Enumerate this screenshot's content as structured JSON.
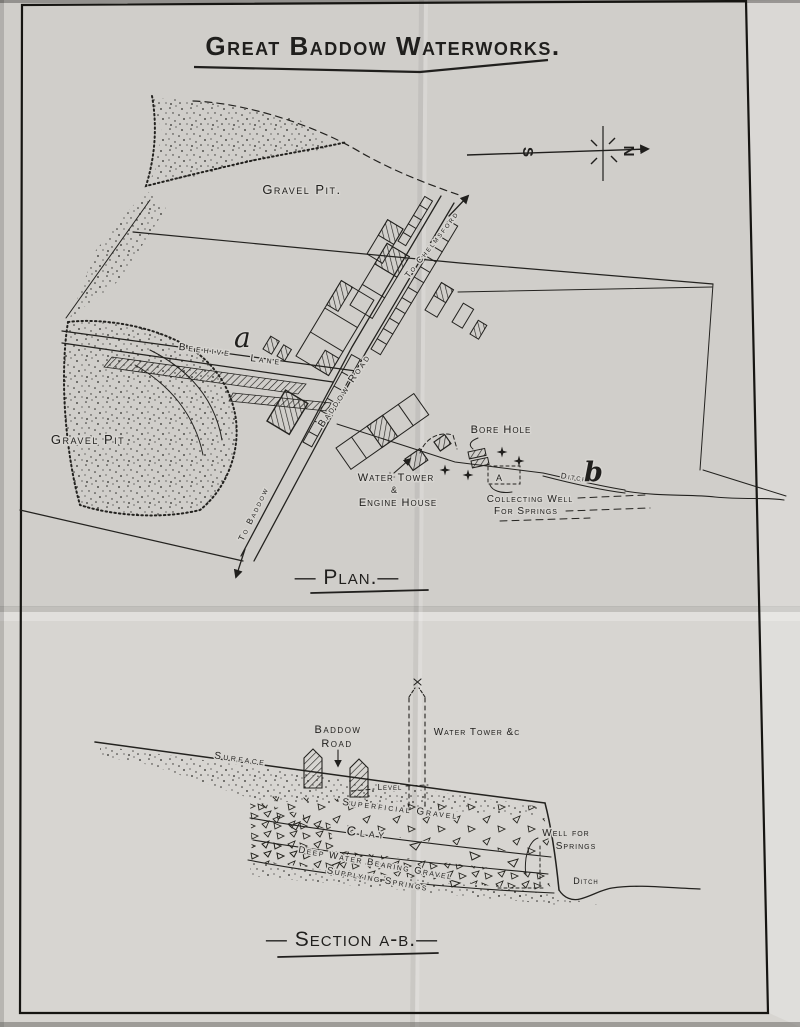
{
  "colors": {
    "paper": "#d7d5d1",
    "ink": "#201f1d"
  },
  "title": "Great Baddow Waterworks.",
  "compass": {
    "north": "N",
    "south": "S"
  },
  "plan": {
    "caption": "— Plan.—",
    "labels": {
      "gravel_pit_top": "Gravel Pit.",
      "gravel_pit_left": "Gravel Pit",
      "beehive": "Beehive",
      "lane": "Lane",
      "baddow_road": "Baddow Road",
      "to_chelmsford": "To Chelmsford",
      "to_baddow": "To Baddow",
      "bore_hole": "Bore Hole",
      "water_tower": "Water Tower",
      "ampersand": "&",
      "engine_house": "Engine House",
      "collecting_well": "Collecting Well",
      "for_springs": "For Springs",
      "ditch": "Ditch",
      "marker_a": "a",
      "marker_a_well": "A",
      "marker_b": "b"
    }
  },
  "section": {
    "caption": "— Section a-b.—",
    "labels": {
      "baddow": "Baddow",
      "road": "Road",
      "water_tower_etc": "Water Tower &c",
      "surface": "Surface",
      "level": "Level",
      "superficial_gravel": "Superficial Gravel",
      "clay": "Clay",
      "deep_water_bearing_gravel": "Deep Water Bearing Gravel",
      "supplying_springs": "Supplying Springs",
      "well_for": "Well for",
      "springs": "Springs",
      "ditch": "Ditch"
    }
  }
}
